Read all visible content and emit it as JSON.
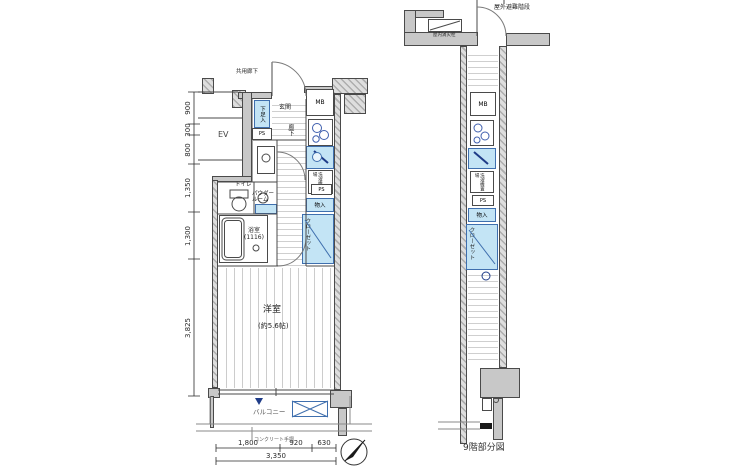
{
  "colors": {
    "background": "#ffffff",
    "wall_fill": "#c8c8c8",
    "wall_line": "#4a4a4a",
    "fixture_fill": "#c3e4f5",
    "fixture_line": "#3f6fae",
    "accent_dark_blue": "#1f3c88",
    "text": "#1f1f1f"
  },
  "main_plan": {
    "common_corridor_label": "共用廊下",
    "elevator_label": "EV",
    "entrance_label": "玄関",
    "shoe_storage_label": "下足入",
    "meter_box_label": "MB",
    "pipe_space_top_label": "PS",
    "pipe_space_mid_label": "PS",
    "corridor_label": "廊下",
    "toilet_label": "トイレ",
    "powder_room_label_line1": "パウダー",
    "powder_room_label_line2": "ルーム",
    "bathroom_label_line1": "浴室",
    "bathroom_label_line2": "(1116)",
    "laundry_label": "洗濯機置場",
    "storage_label": "物入",
    "closet_label": "クローゼット",
    "room_label": "洋室",
    "room_size_label": "(約5.6帖)",
    "balcony_label": "バルコニー",
    "handrail_label": "コンクリート手摺",
    "dim_left": [
      "900",
      "300",
      "800",
      "1,350",
      "1,300",
      "3,825"
    ],
    "dim_bottom": [
      "1,800",
      "920",
      "630"
    ],
    "dim_bottom_total": "3,350"
  },
  "partial_plan": {
    "caption": "9階部分図",
    "outdoor_stairs_label": "屋外避難階段",
    "hydrant_label": "屋内消火栓",
    "meter_box_label": "MB",
    "pipe_space_label": "PS",
    "storage_label": "物入",
    "laundry_label": "洗濯機置場",
    "closet_label": "クローゼット"
  }
}
